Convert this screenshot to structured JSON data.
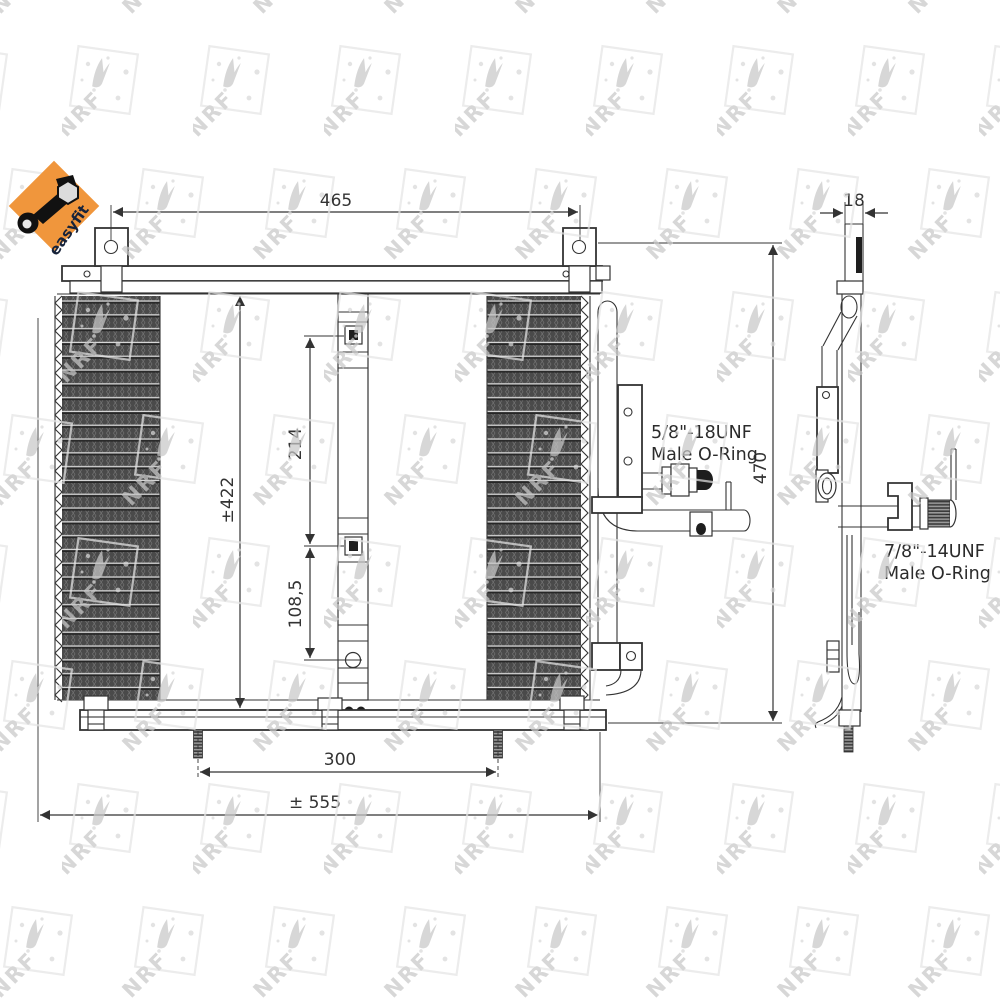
{
  "drawing": {
    "dimensions": {
      "top_mount_spacing": "465",
      "core_height": "±422",
      "port_spacing": "214",
      "lower_port_offset": "108,5",
      "overall_height": "470",
      "stud_spacing": "300",
      "overall_width": "± 555",
      "side_depth": "18"
    },
    "annotations": {
      "top_fitting_line1": "5/8\"-18UNF",
      "top_fitting_line2": "Male O-Ring",
      "side_fitting_line1": "7/8\"-14UNF",
      "side_fitting_line2": "Male O-Ring"
    },
    "badge": {
      "text": "easyfit",
      "color": "#f0963c"
    },
    "watermark": {
      "text": "NRF",
      "color": "#c7c7c7"
    },
    "line_color": "#333333",
    "background": "#ffffff"
  }
}
